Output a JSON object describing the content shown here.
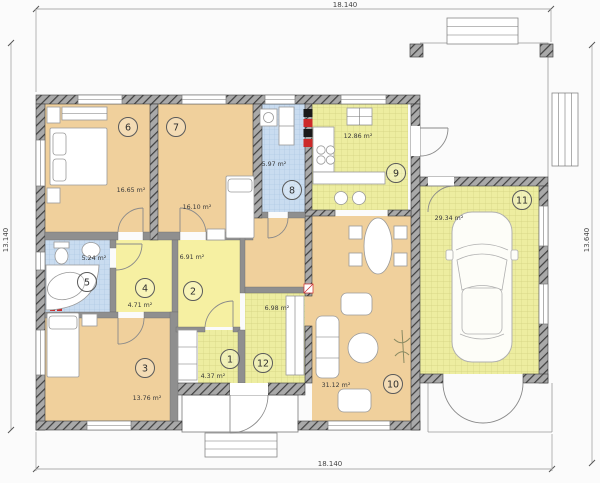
{
  "dimensions": {
    "top": "18.140",
    "bottom": "18.140",
    "left": "13.140",
    "right": "13.640"
  },
  "rooms": [
    {
      "number": "1",
      "area": "4.37 m²",
      "kind": "storage"
    },
    {
      "number": "2",
      "area": "6.91 m²",
      "kind": "hall"
    },
    {
      "number": "3",
      "area": "13.76 m²",
      "kind": "bedroom"
    },
    {
      "number": "4",
      "area": "4.71 m²",
      "kind": "hall"
    },
    {
      "number": "5",
      "area": "5.24 m²",
      "kind": "bathroom"
    },
    {
      "number": "6",
      "area": "16.65 m²",
      "kind": "bedroom"
    },
    {
      "number": "7",
      "area": "16.10 m²",
      "kind": "bedroom"
    },
    {
      "number": "8",
      "area": "5.97 m²",
      "kind": "laundry-bath"
    },
    {
      "number": "9",
      "area": "12.86 m²",
      "kind": "kitchen"
    },
    {
      "number": "10",
      "area": "31.12 m²",
      "kind": "living-room"
    },
    {
      "number": "11",
      "area": "29.34 m²",
      "kind": "garage"
    },
    {
      "number": "12",
      "area": "6.98 m²",
      "kind": "entrance-hall"
    }
  ],
  "colors": {
    "bedroom": "#f0d09c",
    "hall": "#f6f0a2",
    "wet_tile": "#c9dcf0",
    "floor_tile": "#ededa0",
    "wall": "#a9a9a9",
    "accent_red": "#cc2a2a"
  }
}
